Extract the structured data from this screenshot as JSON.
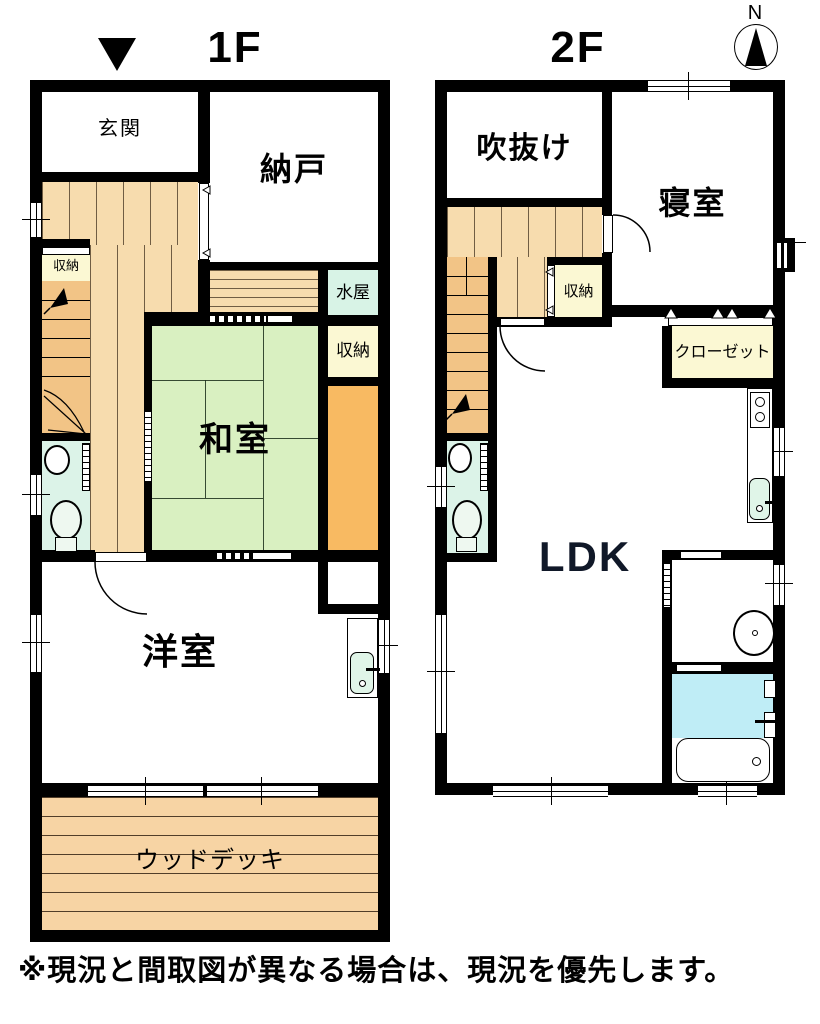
{
  "header": {
    "floor1_label": "1F",
    "floor2_label": "2F",
    "compass_north": "N"
  },
  "floor1": {
    "rooms": {
      "genkan": "玄関",
      "nando": "納戸",
      "storage_small": "収納",
      "mizuya": "水屋",
      "storage_side": "収納",
      "washitsu": "和室",
      "youshitsu": "洋室",
      "wood_deck": "ウッドデッキ"
    }
  },
  "floor2": {
    "rooms": {
      "fukinuke": "吹抜け",
      "bedroom": "寝室",
      "storage": "収納",
      "closet": "クローゼット",
      "ldk": "LDK"
    }
  },
  "footer": {
    "disclaimer": "※現況と間取図が異なる場合は、現況を優先します。"
  },
  "palette": {
    "wall": "#000000",
    "hall_wood": "#f7dcae",
    "stair_wood": "#f2c486",
    "deck_wood": "#f7d4a4",
    "tatami": "#d9f0c1",
    "storage_yellow": "#fbf8d3",
    "mizuya_green": "#d8f3e6",
    "toilet_green": "#dcf3e8",
    "bath_blue": "#bfedf6",
    "closet_orange": "#f8ba62",
    "fixture_green": "#e0f5e8"
  }
}
